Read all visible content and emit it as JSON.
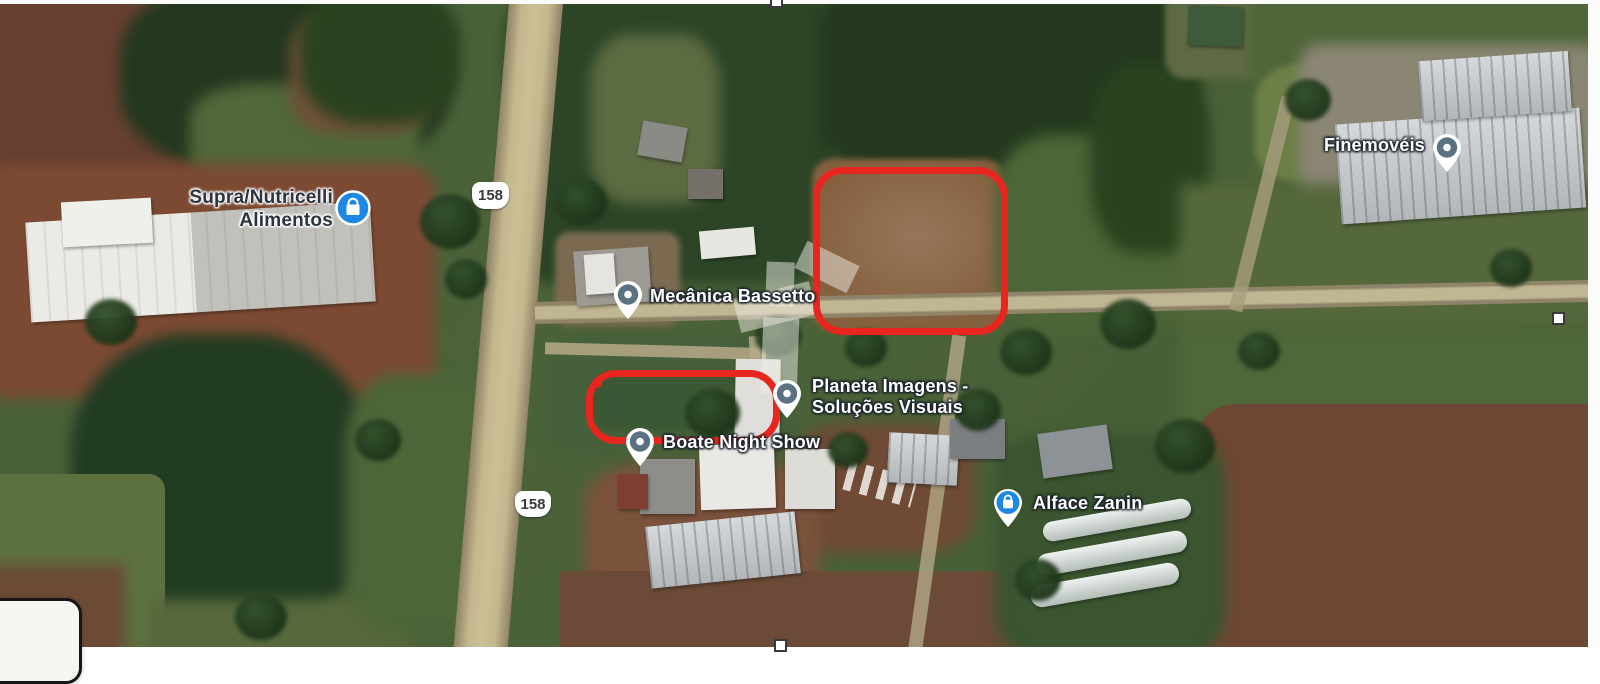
{
  "map": {
    "view": "satellite",
    "labels": {
      "supra": {
        "line1": "Supra/Nutricelli",
        "line2": "Alimentos",
        "marker": "shopping-badge-blue"
      },
      "mecanica": {
        "text": "Mecânica Bassetto",
        "marker": "place-pin"
      },
      "planeta": {
        "line1": "Planeta Imagens -",
        "line2": "Soluções Visuais",
        "marker": "place-pin"
      },
      "boate": {
        "text": "Boate Night Show",
        "marker": "place-pin"
      },
      "alface": {
        "text": "Alface Zanin",
        "marker": "shopping-pin-blue"
      },
      "finemoveis": {
        "text": "Finemovéis",
        "marker": "place-pin"
      }
    },
    "road_shields": {
      "north": "158",
      "south": "158"
    },
    "annotations": [
      {
        "name": "highlighted-lot-large",
        "shape": "rounded-rectangle",
        "color": "#e8251e"
      },
      {
        "name": "highlighted-lot-small",
        "shape": "rounded-rectangle",
        "color": "#e8251e"
      }
    ]
  },
  "editor": {
    "selection_handles": [
      "top-center",
      "right-middle",
      "bottom-center"
    ]
  },
  "colors": {
    "annotation-red": "#e8251e",
    "marker-blue": "#1e88e5",
    "marker-slate": "#5b7282",
    "label-white": "#ffffff",
    "label-dark": "#2b3440",
    "shield-bg": "#ffffff",
    "shield-text": "#3a3a3a",
    "watermark-white": "#efede6"
  }
}
